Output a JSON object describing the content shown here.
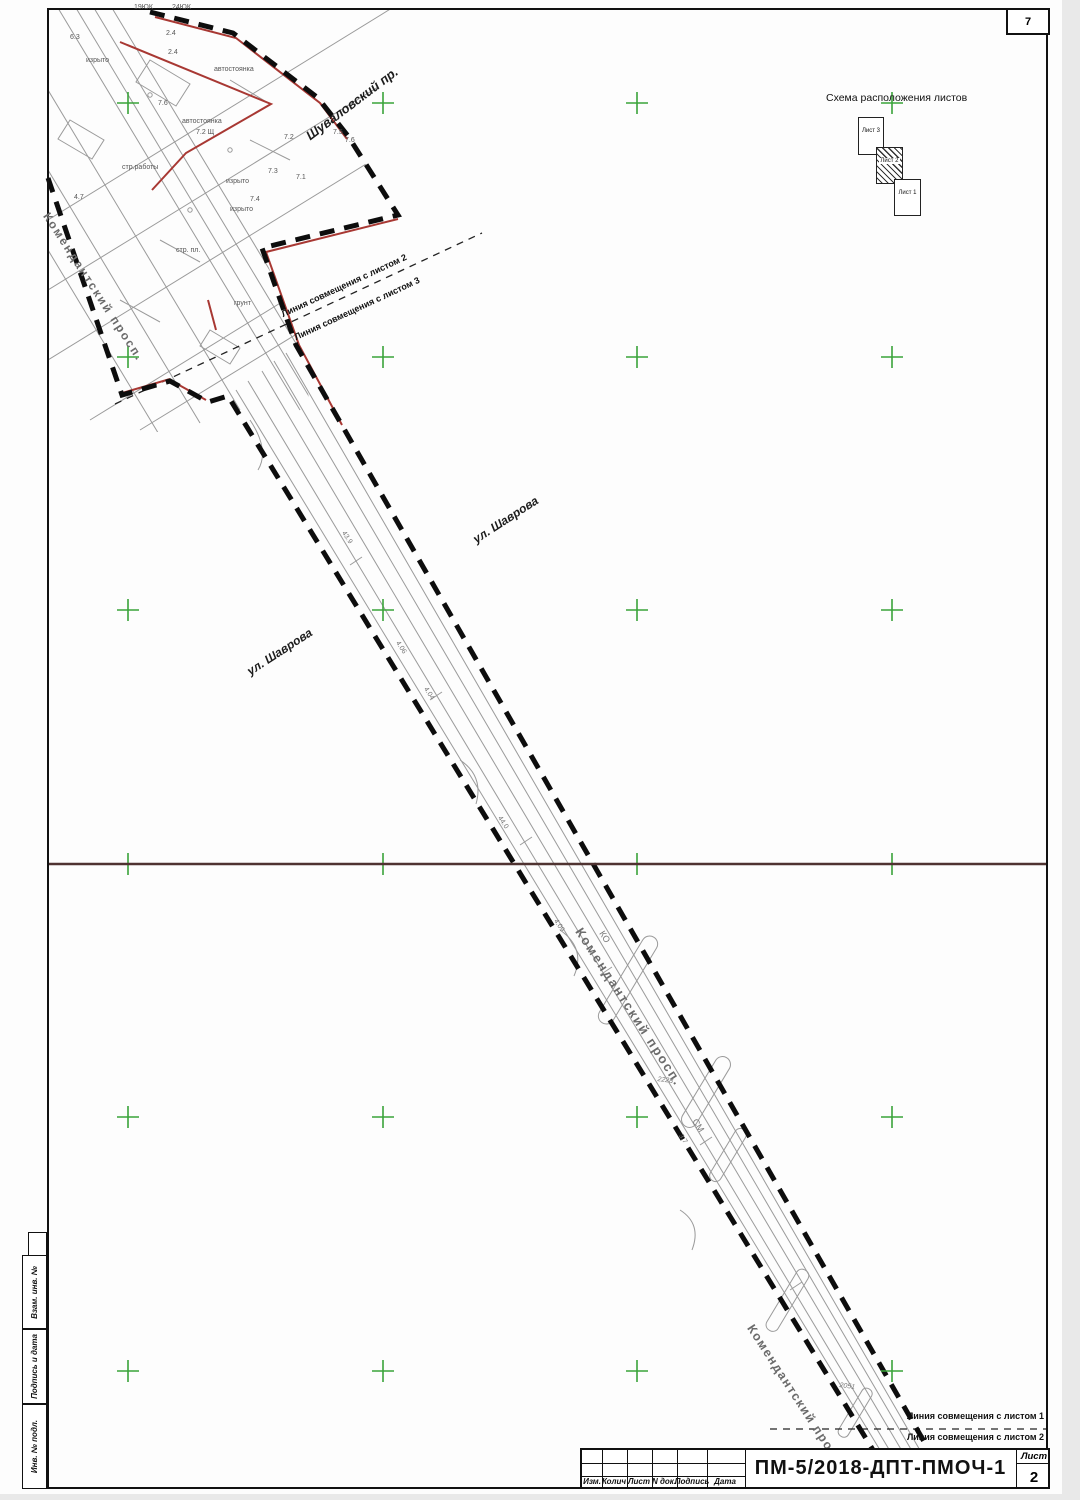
{
  "sheet": {
    "corner_number": "7",
    "stamp": {
      "code": "ПМ-5/2018-ДПТ-ПМОЧ-1",
      "sheet_label": "Лист",
      "sheet_number": "2",
      "columns": [
        "Изм.",
        "Колич",
        "Лист",
        "N док.",
        "Подпись",
        "Дата"
      ]
    },
    "side_labels": [
      "Взам. инв. №",
      "Подпись и дата",
      "Инв. № подл."
    ]
  },
  "schema": {
    "title": "Схема расположения листов",
    "sheets": [
      {
        "label": "Лист 3",
        "hatched": false
      },
      {
        "label": "Лист 2",
        "hatched": true
      },
      {
        "label": "Лист 1",
        "hatched": false
      }
    ]
  },
  "match_lines": {
    "top": [
      "Линия совмещения с листом 2",
      "Линия совмещения с листом 3"
    ],
    "bottom": [
      "Линия совмещения с листом 1",
      "Линия совмещения с листом 2"
    ]
  },
  "streets": {
    "shuvalovsky": "Шуваловский пр.",
    "shavrova": "ул. Шаврова",
    "komendantsky": "Комендантский просп."
  },
  "map_labels": [
    "19ЮК",
    "24ЮК",
    "6.3",
    "изрыто",
    "автостоянка",
    "2.4",
    "2.4",
    "7.6",
    "автостоянка",
    "7.2 Щ",
    "стр.работы",
    "изрыто",
    "изрыто",
    "4.7",
    "стр. пл.",
    "грунт",
    "7.2",
    "7.3",
    "7.1",
    "7.4",
    "7.5",
    "7.6"
  ],
  "corridor_labels": [
    "43.9",
    "4.06",
    "4.04",
    "44.0",
    "4.09",
    "2228",
    "СМ",
    "3.7",
    "2051",
    "КО"
  ],
  "grid": {
    "cols": [
      128,
      383,
      637,
      892
    ],
    "rows": [
      103,
      357,
      610,
      864,
      1117,
      1371
    ]
  },
  "colors": {
    "boundary": "#0d0d0d",
    "red_line": "#a83833",
    "green_cross": "#3aa33a",
    "fold_line": "#4f3331",
    "map_line": "#9a9a9a"
  }
}
